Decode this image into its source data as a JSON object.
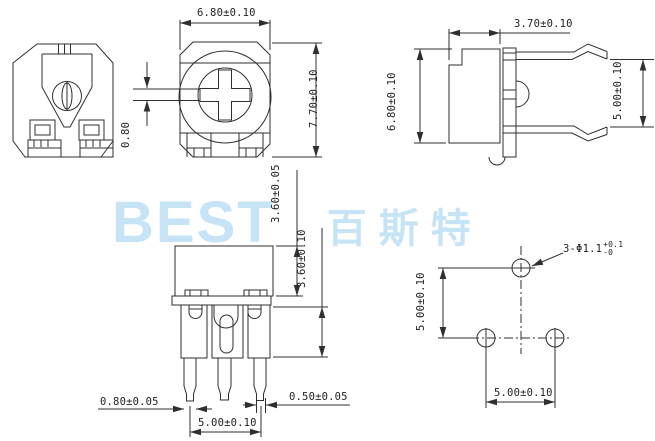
{
  "drawing": {
    "watermark": {
      "latin": "BEST",
      "cjk": "百斯特",
      "color": "#c6e4f6"
    },
    "top_view": {
      "width": "6.80±0.10",
      "height": "7.70±0.10",
      "slot_width": "0.80"
    },
    "side_view": {
      "depth": "3.70±0.10",
      "height": "6.80±0.10",
      "lead_spacing": "5.00±0.10"
    },
    "front_view": {
      "case_height": "3.60±0.05",
      "collar_height": "3.60±0.10",
      "pin_width": "0.80±0.05",
      "pin_tip_width": "0.50±0.05",
      "pin_pitch": "5.00±0.10"
    },
    "hole_pattern": {
      "vertical_pitch": "5.00±0.10",
      "horizontal_pitch": "5.00±0.10",
      "hole_spec": "3-Φ1.1",
      "tol_plus": "+0.1",
      "tol_minus": "-0"
    }
  }
}
